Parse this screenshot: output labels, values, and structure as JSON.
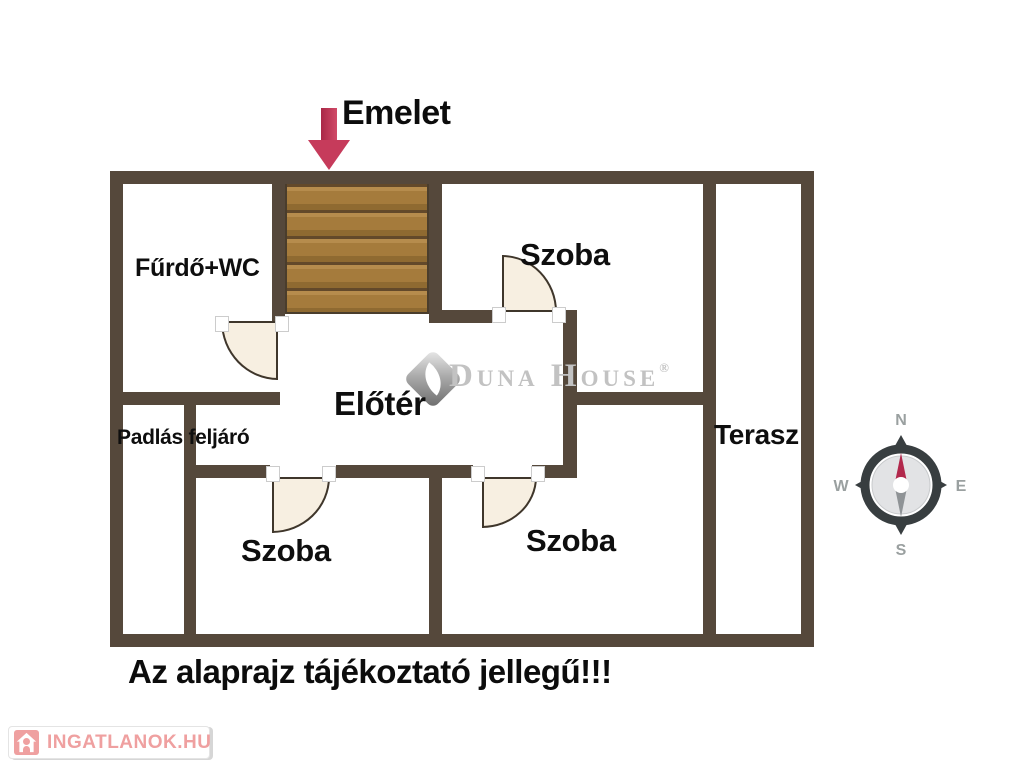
{
  "title": {
    "text": "Emelet"
  },
  "rooms": {
    "bathroom": "Fűrdő+WC",
    "room_top": "Szoba",
    "hall": "Előtér",
    "attic": "Padlás feljáró",
    "room_bottom_left": "Szoba",
    "room_bottom_mid": "Szoba",
    "terrace": "Terasz"
  },
  "disclaimer": "Az alaprajz tájékoztató jellegű!!!",
  "watermark": {
    "brand": "Duna House",
    "registered": "®"
  },
  "compass": {
    "north": "N",
    "east": "E",
    "south": "S",
    "west": "W"
  },
  "badge": {
    "label": "INGATLANOK.HU"
  },
  "colors": {
    "wall": "#55483b",
    "stairs_wood": "#a57b3c",
    "door_fill": "#f7efe1",
    "arrow_red": "#c63b5b",
    "compass_needle_north": "#b2284c",
    "compass_needle_south": "#8f9396",
    "badge_pink": "#efa0a0",
    "watermark_gray": "#c2c2c2"
  }
}
